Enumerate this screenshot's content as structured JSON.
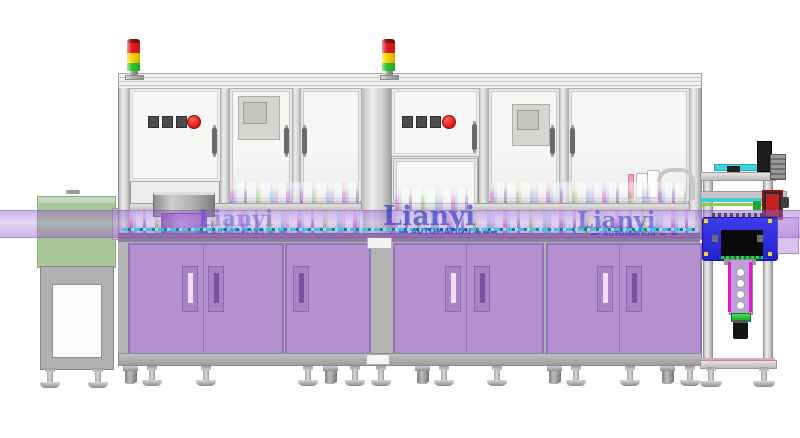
{
  "image_type": "3d-cad-render-of-automation-line",
  "watermarks": [
    {
      "brand": "Lianyi",
      "subtitle": "AUTOMATION"
    },
    {
      "brand": "Lianyi",
      "subtitle": "AUTOMATION"
    },
    {
      "brand": "Lianyi",
      "subtitle": "AUTOMATION"
    }
  ],
  "palette": {
    "cabinet_purple": "#b291ce",
    "band_purple": "rgba(168,116,218,0.38)",
    "unit_blue": "#2f2fe2",
    "signal_red": "#e41c1c",
    "signal_yellow": "#ffd400",
    "signal_green": "#2bc82b",
    "feeder_green_line": "#2ad010",
    "conveyor_cyan": "#38c8d8",
    "watermark_blue": "#2433c0",
    "left_machine_green": "#aac79a"
  }
}
